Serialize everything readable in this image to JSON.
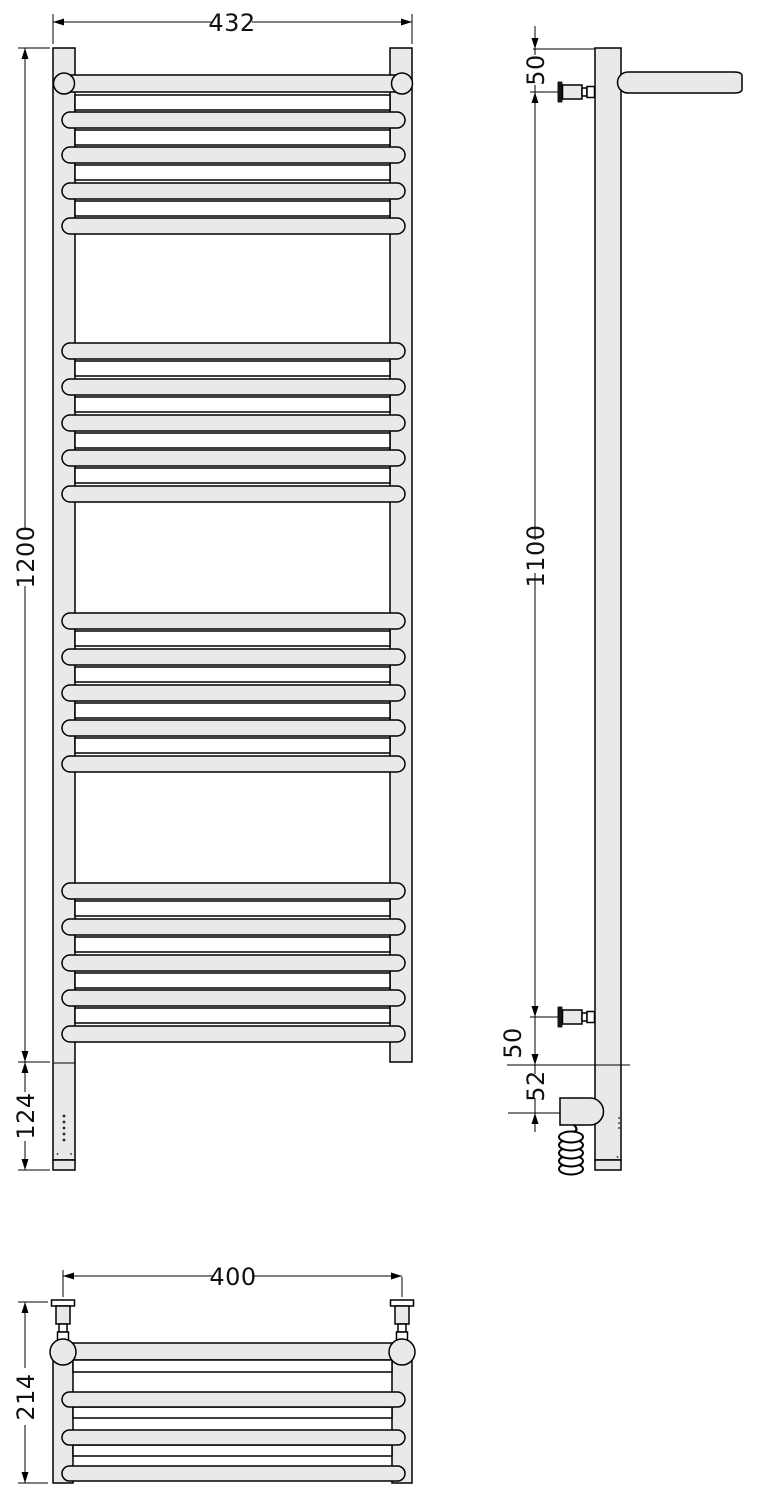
{
  "drawing": {
    "front_view": {
      "width_label": "432",
      "height_label": "1200",
      "electronics_label": "124"
    },
    "side_view": {
      "top_bracket_offset_label": "50",
      "bracket_span_label": "1100",
      "bottom_bracket_offset_label": "50",
      "element_offset_label": "52"
    },
    "top_view": {
      "mount_width_label": "400",
      "depth_label": "214"
    }
  },
  "colors": {
    "part_fill": "#e9e9e9",
    "line": "#000000",
    "background": "#ffffff"
  }
}
